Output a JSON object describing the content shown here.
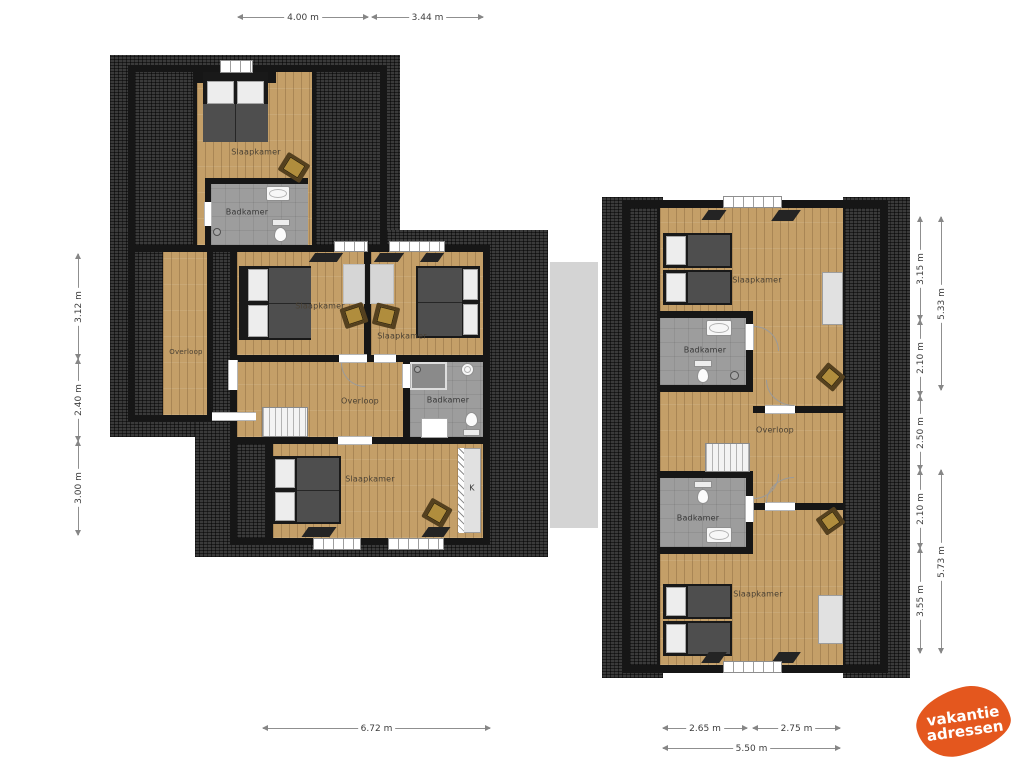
{
  "palette": {
    "roof": "#3a3a3a",
    "wall": "#161616",
    "wood_floor": "#c49f68",
    "bathroom_floor": "#9d9d9d",
    "connector": "#d4d4d4",
    "logo_orange": "#e4571e"
  },
  "dimensions": {
    "top": [
      "4.00 m",
      "3.44 m"
    ],
    "left_side": [
      "3.12 m",
      "2.40 m",
      "3.00 m"
    ],
    "bottom_left": "6.72 m",
    "right_side_inner": [
      "3.15 m",
      "2.10 m",
      "2.50 m",
      "2.10 m",
      "3.55 m"
    ],
    "right_side_outer": [
      "5.33 m",
      "5.73 m"
    ],
    "bottom_right_segments": [
      "2.65 m",
      "2.75 m"
    ],
    "bottom_right_total": "5.50 m"
  },
  "left_building": {
    "rooms": [
      {
        "id": "slaapkamer-top",
        "label": "Slaapkamer"
      },
      {
        "id": "badkamer-top",
        "label": "Badkamer"
      },
      {
        "id": "overloop-west",
        "label": "Overloop"
      },
      {
        "id": "slaapkamer-mid-left",
        "label": "Slaapkamer"
      },
      {
        "id": "slaapkamer-mid-right",
        "label": "Slaapkamer"
      },
      {
        "id": "overloop-central",
        "label": "Overloop"
      },
      {
        "id": "badkamer-central",
        "label": "Badkamer"
      },
      {
        "id": "slaapkamer-south",
        "label": "Slaapkamer"
      },
      {
        "id": "closet",
        "label": "K"
      }
    ]
  },
  "right_building": {
    "rooms": [
      {
        "id": "slaapkamer-north",
        "label": "Slaapkamer"
      },
      {
        "id": "badkamer-north",
        "label": "Badkamer"
      },
      {
        "id": "overloop",
        "label": "Overloop"
      },
      {
        "id": "badkamer-south",
        "label": "Badkamer"
      },
      {
        "id": "slaapkamer-south",
        "label": "Slaapkamer"
      }
    ]
  },
  "logo": {
    "line1": "vakantie",
    "line2": "adressen"
  }
}
